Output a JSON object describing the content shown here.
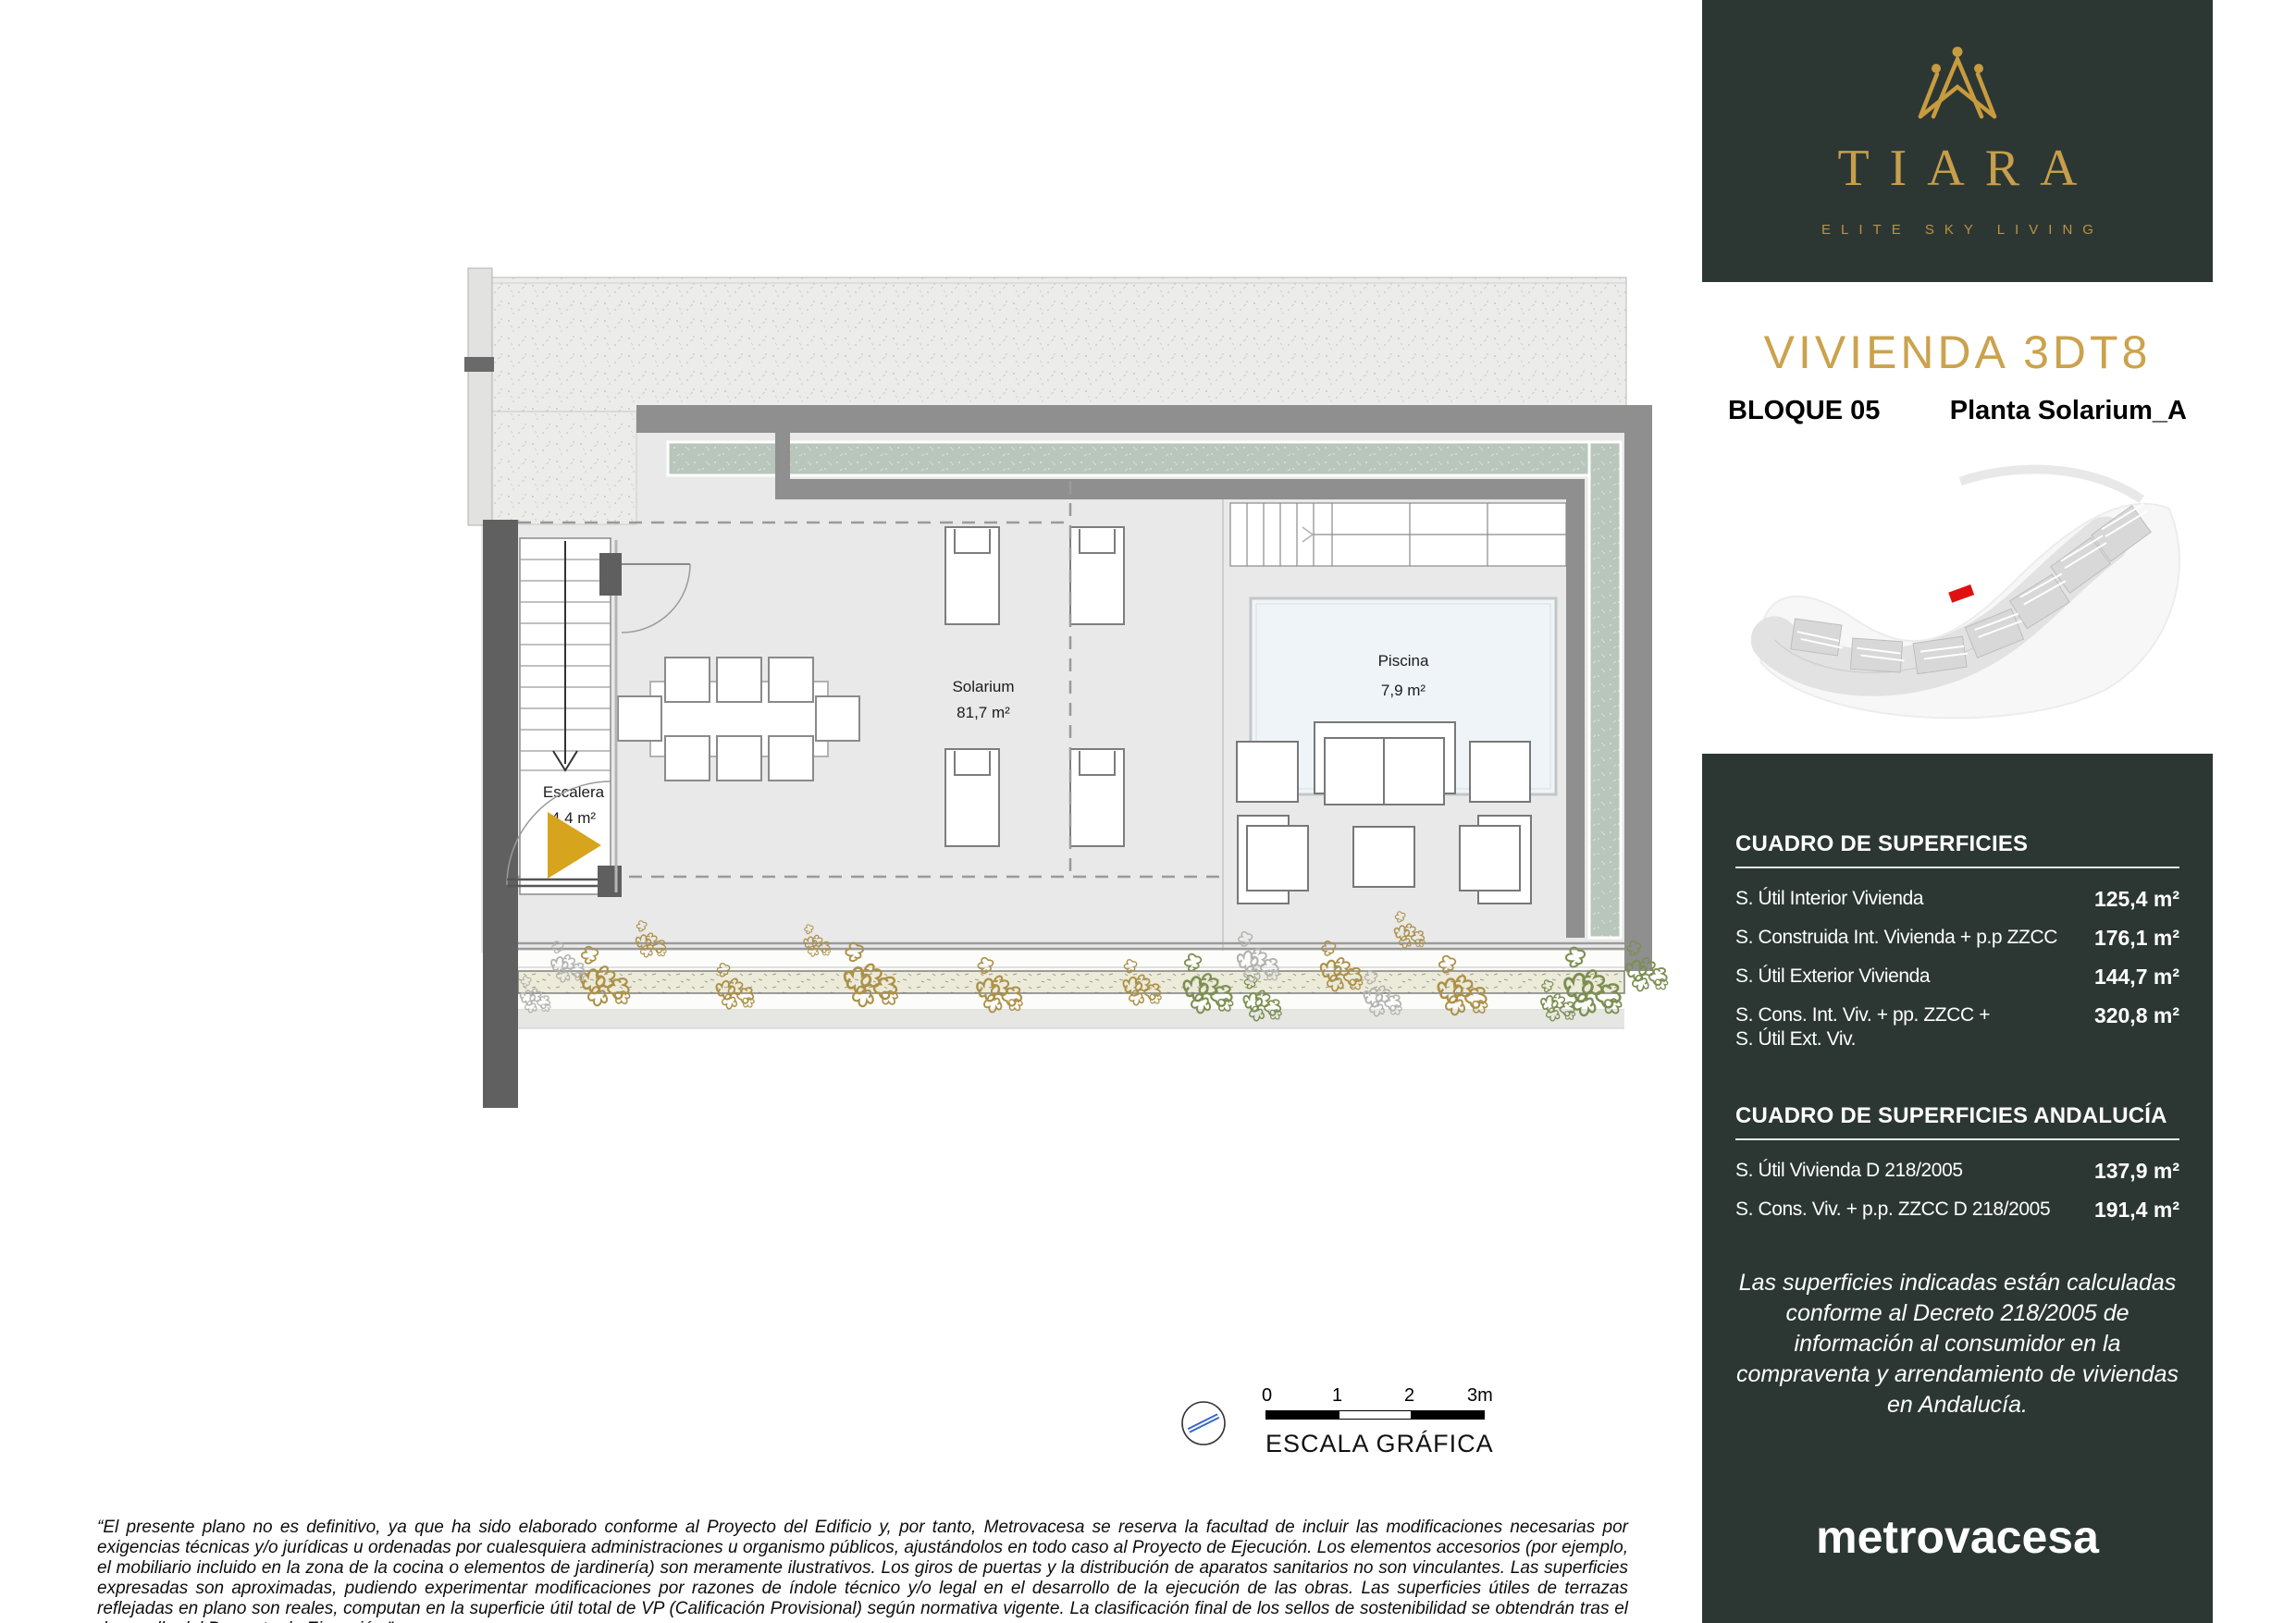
{
  "brand": {
    "name": "TIARA",
    "tagline": "ELITE SKY LIVING",
    "developer": "metrovacesa"
  },
  "header": {
    "title": "VIVIENDA  3DT8",
    "block_label": "BLOQUE  05",
    "plan_label": "Planta Solarium_A"
  },
  "plan": {
    "rooms": [
      {
        "name": "Solarium",
        "area": "81,7 m²"
      },
      {
        "name": "Piscina",
        "area": "7,9 m²"
      },
      {
        "name": "Escalera",
        "area": "4,4 m²"
      }
    ]
  },
  "scale_bar": {
    "ticks": [
      "0",
      "1",
      "2",
      "3m"
    ],
    "label": "ESCALA GRÁFICA"
  },
  "surface_tables": [
    {
      "title": "CUADRO DE SUPERFICIES",
      "rows": [
        {
          "label": "S. Útil Interior Vivienda",
          "value": "125,4 m²"
        },
        {
          "label": "S. Construida Int. Vivienda + p.p ZZCC",
          "value": "176,1 m²"
        },
        {
          "label": "S. Útil Exterior Vivienda",
          "value": "144,7 m²"
        },
        {
          "label": "S. Cons. Int. Viv. + pp. ZZCC +\nS. Útil Ext. Viv.",
          "value": "320,8 m²"
        }
      ]
    },
    {
      "title": "CUADRO DE SUPERFICIES ANDALUCÍA",
      "rows": [
        {
          "label": "S. Útil Vivienda D 218/2005",
          "value": "137,9 m²"
        },
        {
          "label": "S. Cons. Viv. + p.p. ZZCC D 218/2005",
          "value": "191,4 m²"
        }
      ]
    }
  ],
  "legal_note": "Las superficies indicadas están calculadas conforme al Decreto 218/2005 de información al consumidor en la compraventa y arrendamiento de viviendas en Andalucía.",
  "disclaimer": "“El presente plano no es definitivo, ya que ha sido elaborado conforme al Proyecto del Edificio y, por tanto, Metrovacesa se reserva la facultad de incluir las modificaciones necesarias por exigencias técnicas y/o jurídicas u ordenadas por cualesquiera administraciones u organismo públicos, ajustándolos en todo caso al Proyecto de Ejecución. Los elementos accesorios (por ejemplo, el mobiliario incluido en la zona de la cocina o elementos de jardinería) son meramente ilustrativos. Los giros de puertas y la distribución de aparatos sanitarios no son vinculantes. Las superficies expresadas son aproximadas, pudiendo experimentar modificaciones por razones de índole técnico y/o legal en el desarrollo de la ejecución de las obras. Las superficies útiles de terrazas reflejadas en plano son reales, computan en la superficie útil total de VP (Calificación Provisional) según normativa vigente. La clasificación final de los sellos de sostenibilidad se obtendrán tras el desarrollo del Proyecto de Ejecución.”",
  "colors": {
    "accent_gold": "#c9a14e",
    "panel_dark": "#2c3734",
    "highlight_red": "#e01010",
    "planter_green": "#b8c6bb",
    "pool_blue": "#eef4f8",
    "wall_gray": "#8f8f8f"
  }
}
